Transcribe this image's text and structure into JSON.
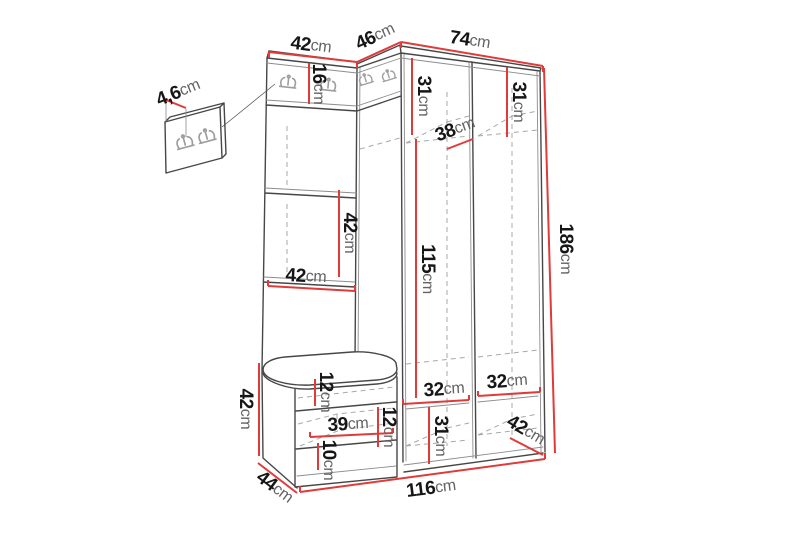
{
  "page": {
    "background": "#ffffff",
    "accent_red": "#e03a3a",
    "line_dark": "#474747",
    "line_light": "#8d8d8d",
    "dash_gray": "#a8a8a8",
    "value_color": "#161616",
    "unit_color": "#636363"
  },
  "diagram": {
    "kind": "furniture-dimension-drawing",
    "subject": "corner hallway wardrobe with coat-hook panels, open shelves, shoe bench and separate wall hook panel",
    "unit": "cm",
    "icons": {
      "coat_hook": "coat-hook-icon"
    },
    "labels": [
      {
        "name": "wall-panel-depth",
        "value": "4,6",
        "unit": "cm"
      },
      {
        "name": "top-left-section-width",
        "value": "42",
        "unit": "cm"
      },
      {
        "name": "corner-section-width",
        "value": "46",
        "unit": "cm"
      },
      {
        "name": "right-section-width",
        "value": "74",
        "unit": "cm"
      },
      {
        "name": "hook-panel-height",
        "value": "16",
        "unit": "cm"
      },
      {
        "name": "right-col1-top-compartment-height",
        "value": "31",
        "unit": "cm"
      },
      {
        "name": "right-col2-top-compartment-height",
        "value": "31",
        "unit": "cm"
      },
      {
        "name": "corner-compartment-depth",
        "value": "38",
        "unit": "cm"
      },
      {
        "name": "left-middle-compartment-height",
        "value": "42",
        "unit": "cm"
      },
      {
        "name": "left-compartment-width",
        "value": "42",
        "unit": "cm"
      },
      {
        "name": "interior-height",
        "value": "115",
        "unit": "cm"
      },
      {
        "name": "overall-height",
        "value": "186",
        "unit": "cm"
      },
      {
        "name": "bench-height",
        "value": "42",
        "unit": "cm"
      },
      {
        "name": "bench-top-rail-height",
        "value": "12",
        "unit": "cm"
      },
      {
        "name": "bench-niche-width",
        "value": "39",
        "unit": "cm"
      },
      {
        "name": "bench-niche-height",
        "value": "12",
        "unit": "cm"
      },
      {
        "name": "bench-bottom-rail-height",
        "value": "10",
        "unit": "cm"
      },
      {
        "name": "bench-depth",
        "value": "44",
        "unit": "cm"
      },
      {
        "name": "right-col1-bottom-shelf-width",
        "value": "32",
        "unit": "cm"
      },
      {
        "name": "right-col2-bottom-shelf-width",
        "value": "32",
        "unit": "cm"
      },
      {
        "name": "right-col1-bottom-compartment-height",
        "value": "31",
        "unit": "cm"
      },
      {
        "name": "right-section-depth",
        "value": "42",
        "unit": "cm"
      },
      {
        "name": "overall-width",
        "value": "116",
        "unit": "cm"
      }
    ]
  }
}
